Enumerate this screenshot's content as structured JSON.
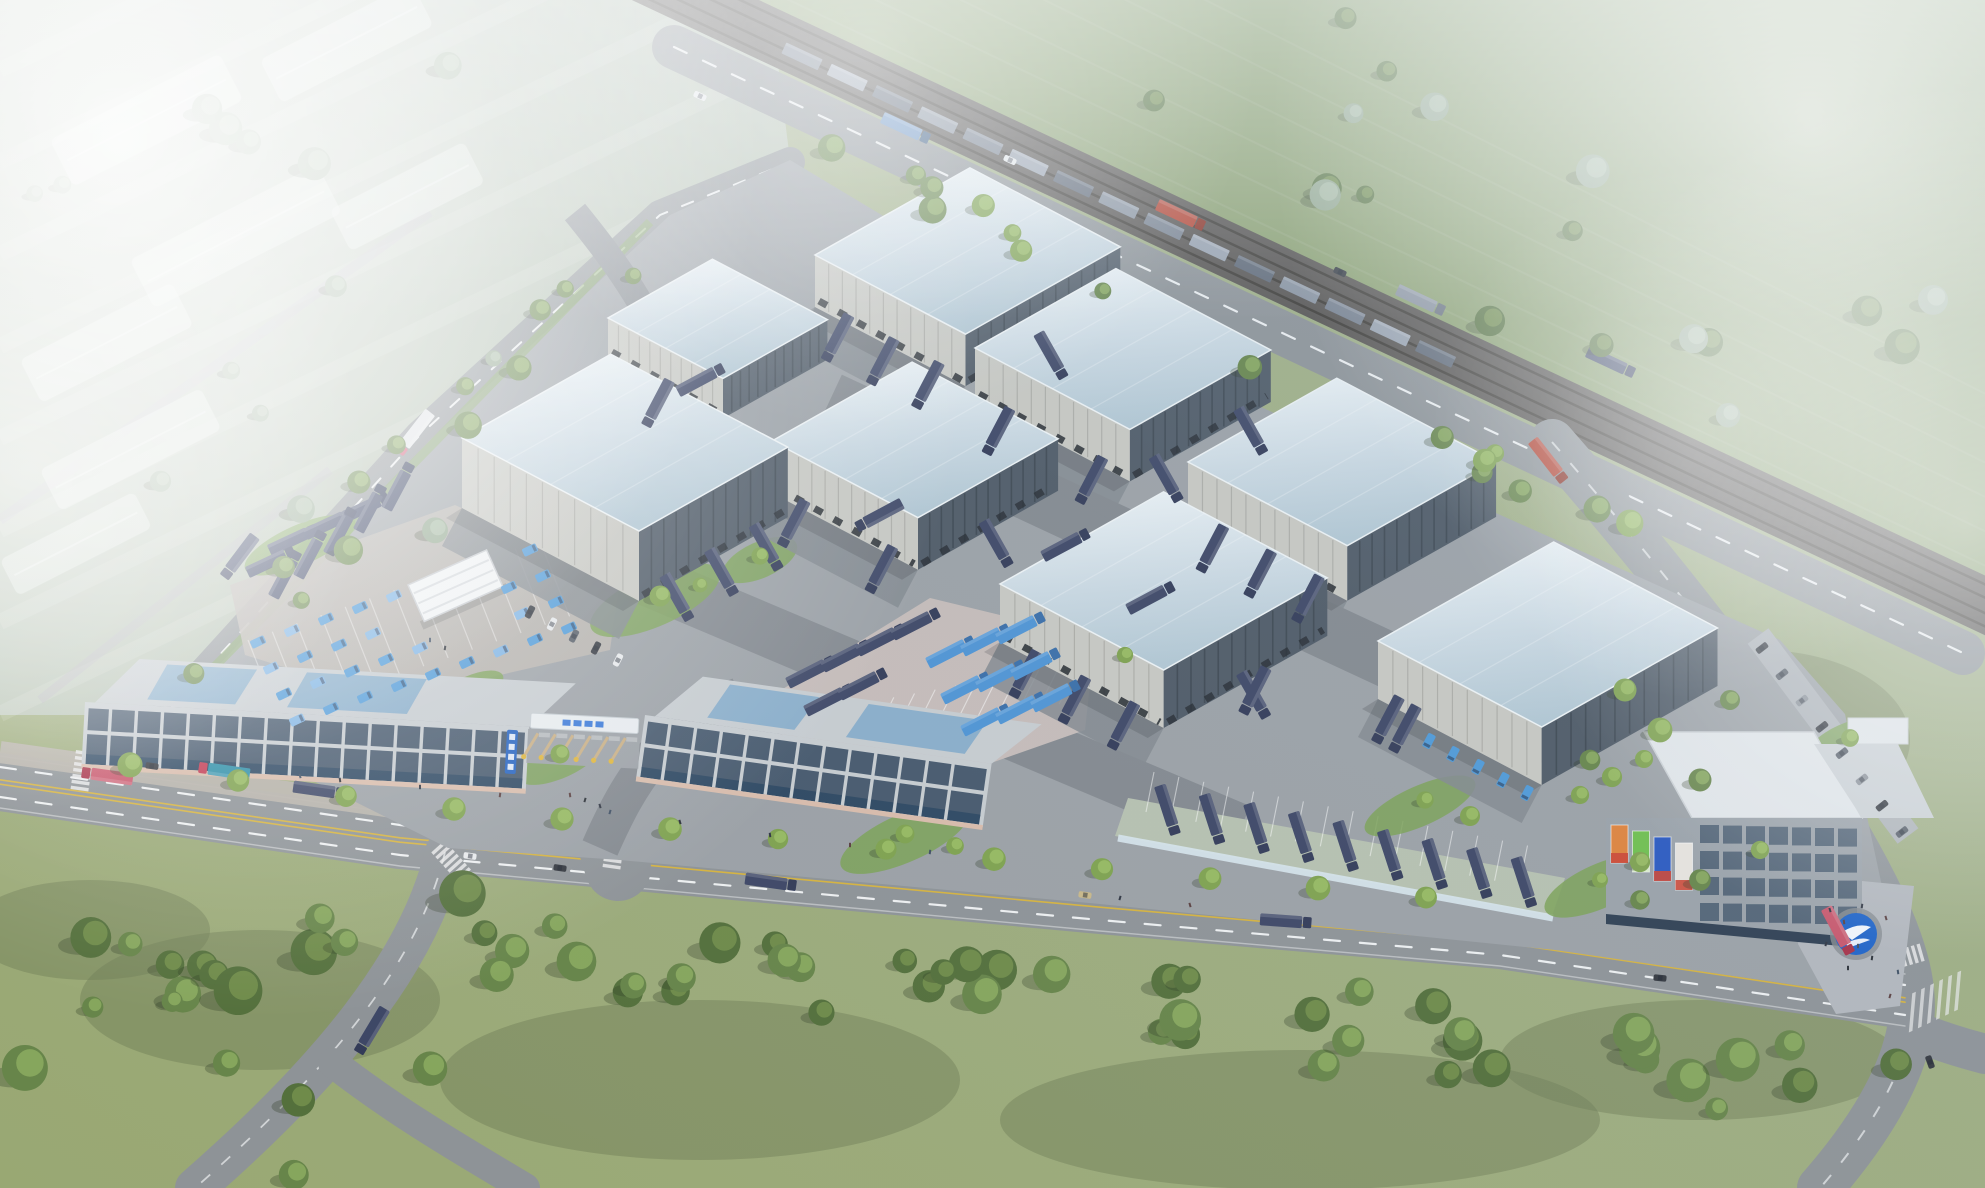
{
  "scene": {
    "kind": "aerial-architectural-rendering",
    "subject": "logistics-park-masterplan",
    "warehouse_count": 8,
    "gate_lane_count": 6,
    "tower_billboard_count": 4,
    "landmarks": [
      "warehouse-cluster",
      "entrance-gate",
      "commercial-building-west",
      "commercial-building-east",
      "office-tower",
      "logo-medallion-plaza",
      "van-parking-lot",
      "site-office-hut",
      "truck-parking-lot",
      "truck-canopy-row",
      "freight-railway",
      "freight-train",
      "highway",
      "front-road",
      "branch-road",
      "tree-belt",
      "farm-fields",
      "greenhouses"
    ]
  },
  "colors": {
    "base_a": "#99a873",
    "base_b": "#a3b28e",
    "field_mist": "#b7c3b5",
    "field_green": "#8aa06e",
    "grass_dark": "#75875c",
    "grass_darker": "#6e7c57",
    "tree_base": "#67854a",
    "tree_light": "#8fae62",
    "tree_dark": "#49602f",
    "tree_mist": "#93a88f",
    "tree_shadow": "#2f3b26",
    "greenhouse": "#e9efe9",
    "field_road": "#b4aec0",
    "road": "#8e9397",
    "road_dark": "#7e8386",
    "lane_yellow": "#d6b33f",
    "lane_white": "#eef0f1",
    "sidewalk": "#b6b1a9",
    "walk_pink": "#c8b8a8",
    "rail_bed": "#575350",
    "rail_steel": "#39352f",
    "site_concrete": "#9ca1a6",
    "yard_asphalt": "#84898f",
    "apron_light": "#aeb3b8",
    "roof_light": "#e9f0f4",
    "roof_shade": "#b7cbd6",
    "roof_edge": "#eef3f5",
    "wall_light": "#c8c8c2",
    "wall_dark": "#4f5a66",
    "wall_darker": "#3a444e",
    "dock_door": "#23282e",
    "pad_pink": "#c6bcb9",
    "pad_pale": "#b9b4ae",
    "stall_green": "#b7c1b0",
    "canopy_glass": "#d8e6ee",
    "van_blue": "#4f9ad8",
    "van_blue_light": "#7fb4e4",
    "truck_navy": "#3e4766",
    "truck_navy_dark": "#333b58",
    "truck_lightblue": "#4f94d4",
    "cab_red": "#c23a52",
    "cab_pink": "#d4607a",
    "trailer_pink": "#c9566b",
    "container_teal": "#2f8fa8",
    "car_white": "#e8eaec",
    "car_dark": "#34383f",
    "car_tan": "#c9b888",
    "train_a": "#78818f",
    "train_b": "#9aa3b0",
    "train_c": "#5f6876",
    "bldg_frame": "#c7ccd0",
    "bldg_frame_dark": "#9ba2a9",
    "bldg_glass": "#47596d",
    "storefront": "#2e4862",
    "roof_glass": "#7fa8c9",
    "base_pink": "#d9bcab",
    "sign_blue": "#2563c0",
    "hut_white": "#f2f4f5",
    "tower_roof": "#e2e6e9",
    "tower_base": "#2f3f52",
    "medallion_blue": "#1e63c8",
    "medallion_ring": "#878c91",
    "plaza": "#b3b7bd",
    "bb_orange": "#e0833c",
    "bb_green": "#6fbf4e",
    "bb_blue": "#2b59c0",
    "bb_white": "#e8e4de",
    "bb_red": "#cc4433",
    "barrier_tan": "#c9af85",
    "barrier_yellow": "#e0b63c",
    "gate_canopy": "#e8ecef",
    "gate_logo": "#2a6fd6",
    "bins_blue": "#2f6fc0",
    "people": "#2b2f36",
    "shadow": "#2c3138",
    "fog": "#ffffff",
    "hedge": "#7da257"
  }
}
